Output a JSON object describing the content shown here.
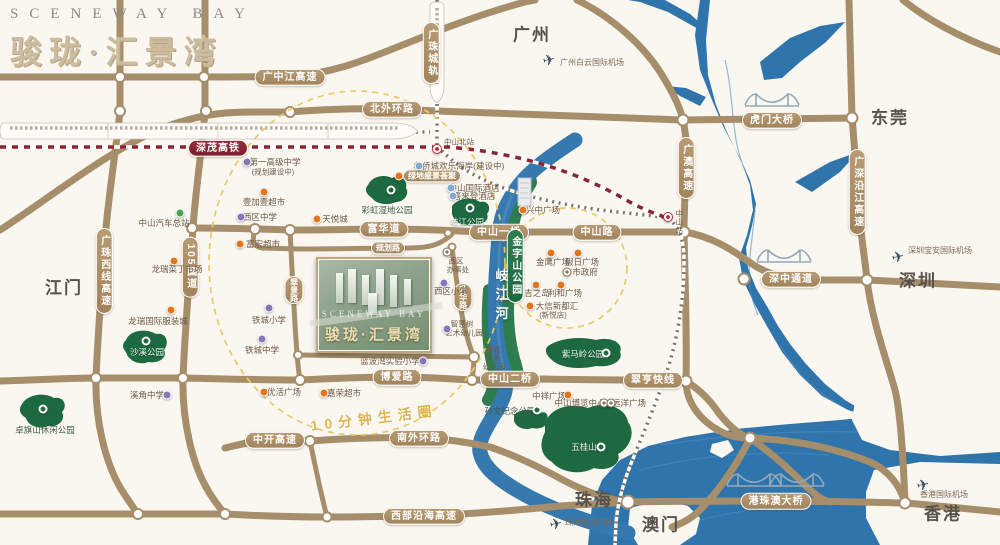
{
  "logo": {
    "en": "SCENEWAY BAY",
    "cn": "骏珑·汇景湾"
  },
  "project": {
    "watermark": "SCENEWAY BAY",
    "title": "骏珑·汇景湾"
  },
  "life_circle_label": {
    "t": "10分钟生活圈",
    "x": 374,
    "y": 418
  },
  "river_label": {
    "t": "岐江河",
    "x": 501,
    "y": 297
  },
  "colors": {
    "road": "#a68e6b",
    "water": "#3074ac",
    "park": "#1d6a40",
    "badge": "#a98b61",
    "rail_badge": "#8c2433",
    "dash_circle": "#e9c967",
    "accent_gold": "#cdbc9e",
    "orange_poi": "#e2761d",
    "school_poi": "#8678b8"
  },
  "badges": [
    {
      "t": "广中江高速",
      "x": 290,
      "y": 77,
      "o": "h",
      "n": "badge-guangzhongjiang-expwy"
    },
    {
      "t": "北外环路",
      "x": 392,
      "y": 109,
      "o": "h",
      "n": "badge-north-outer-ring"
    },
    {
      "t": "深茂高铁",
      "x": 218,
      "y": 148,
      "o": "h",
      "c": "rail",
      "n": "badge-shenmao-hsr"
    },
    {
      "t": "广珠城轨",
      "x": 431,
      "y": 53,
      "o": "v",
      "n": "badge-guangzhu-rail"
    },
    {
      "t": "富华道",
      "x": 384,
      "y": 229,
      "o": "h",
      "n": "badge-fuhua-road"
    },
    {
      "t": "规划路",
      "x": 388,
      "y": 248,
      "o": "h",
      "s": 1,
      "n": "badge-planned-road"
    },
    {
      "t": "中山一桥",
      "x": 499,
      "y": 232,
      "o": "h",
      "n": "badge-zhongshan-bridge-1"
    },
    {
      "t": "中山路",
      "x": 597,
      "y": 232,
      "o": "h",
      "n": "badge-zhongshan-road"
    },
    {
      "t": "广澳高速",
      "x": 686,
      "y": 168,
      "o": "v",
      "n": "badge-guangao-expwy"
    },
    {
      "t": "广深沿江高速",
      "x": 857,
      "y": 192,
      "o": "v",
      "n": "badge-guangshen-riverside-expwy"
    },
    {
      "t": "广珠西线高速",
      "x": 104,
      "y": 271,
      "o": "v",
      "n": "badge-guangzhu-west-expwy"
    },
    {
      "t": "105国道",
      "x": 190,
      "y": 267,
      "o": "v",
      "n": "badge-g105"
    },
    {
      "t": "翠景路",
      "x": 294,
      "y": 290,
      "o": "v",
      "s": 1,
      "n": "badge-cuijing-road"
    },
    {
      "t": "升华路",
      "x": 463,
      "y": 297,
      "o": "v",
      "s": 1,
      "n": "badge-shenghua-road"
    },
    {
      "t": "金字山公园",
      "x": 515,
      "y": 266,
      "o": "v",
      "c": "green",
      "n": "badge-jinzishan-park"
    },
    {
      "t": "博爱路",
      "x": 397,
      "y": 377,
      "o": "h",
      "n": "badge-boai-road"
    },
    {
      "t": "中山二桥",
      "x": 510,
      "y": 379,
      "o": "h",
      "n": "badge-zhongshan-bridge-2"
    },
    {
      "t": "翠亨快线",
      "x": 653,
      "y": 380,
      "o": "h",
      "n": "badge-cuiheng-express"
    },
    {
      "t": "南外环路",
      "x": 419,
      "y": 438,
      "o": "h",
      "n": "badge-south-outer-ring"
    },
    {
      "t": "中开高速",
      "x": 275,
      "y": 440,
      "o": "h",
      "n": "badge-zhongkai-expwy"
    },
    {
      "t": "西部沿海高速",
      "x": 424,
      "y": 516,
      "o": "h",
      "n": "badge-west-coastal-expwy"
    },
    {
      "t": "深中通道",
      "x": 791,
      "y": 279,
      "o": "h",
      "n": "badge-shenzhong-corridor"
    },
    {
      "t": "虎门大桥",
      "x": 772,
      "y": 120,
      "o": "h",
      "n": "badge-humen-bridge"
    },
    {
      "t": "港珠澳大桥",
      "x": 776,
      "y": 501,
      "o": "h",
      "n": "badge-hzm-bridge"
    },
    {
      "t": "绿地盛景荟聚",
      "x": 432,
      "y": 176,
      "o": "h",
      "s": 1,
      "n": "badge-shengjing-huiju"
    }
  ],
  "labels": [
    {
      "t": "广州",
      "x": 532,
      "y": 35,
      "c": "city",
      "n": "city-guangzhou"
    },
    {
      "t": "东莞",
      "x": 890,
      "y": 118,
      "c": "city",
      "n": "city-dongguan"
    },
    {
      "t": "深圳",
      "x": 918,
      "y": 281,
      "c": "city",
      "n": "city-shenzhen"
    },
    {
      "t": "江门",
      "x": 64,
      "y": 288,
      "c": "city",
      "n": "city-jiangmen"
    },
    {
      "t": "珠海",
      "x": 594,
      "y": 500,
      "c": "city",
      "n": "city-zhuhai"
    },
    {
      "t": "澳门",
      "x": 661,
      "y": 525,
      "c": "city",
      "n": "city-macau"
    },
    {
      "t": "香港",
      "x": 943,
      "y": 514,
      "c": "city",
      "n": "city-hongkong"
    },
    {
      "t": "广州白云国际机场",
      "x": 592,
      "y": 63,
      "c": "air",
      "n": "label-baiyun-airport"
    },
    {
      "t": "深圳宝安国际机场",
      "x": 940,
      "y": 251,
      "c": "air",
      "n": "label-baoan-airport"
    },
    {
      "t": "珠海金湾机场",
      "x": 589,
      "y": 523,
      "c": "air",
      "n": "label-jinwan-airport"
    },
    {
      "t": "香港国际机场",
      "x": 944,
      "y": 495,
      "c": "air",
      "n": "label-hk-airport"
    },
    {
      "t": "中山北站",
      "x": 459,
      "y": 142,
      "c": "tiny",
      "n": "label-zhongshan-north-station"
    },
    {
      "t": "中山站",
      "x": 679,
      "y": 222,
      "c": "tv",
      "n": "label-zhongshan-station"
    },
    {
      "t": "彩虹湿地公园",
      "x": 387,
      "y": 210,
      "c": "park",
      "n": "label-rainbow-wetland-park"
    },
    {
      "t": "岐江公园",
      "x": 467,
      "y": 222,
      "c": "parkw",
      "n": "label-qijiang-park"
    },
    {
      "t": "沙溪公园",
      "x": 147,
      "y": 352,
      "c": "parkw",
      "n": "label-shaxi-park"
    },
    {
      "t": "卓旗山休闲公园",
      "x": 45,
      "y": 430,
      "c": "park",
      "n": "label-zhuoqishan-park"
    },
    {
      "t": "紫马岭公园",
      "x": 583,
      "y": 354,
      "c": "parkw",
      "n": "label-zimaling-park"
    },
    {
      "t": "五桂山",
      "x": 584,
      "y": 447,
      "c": "parkw",
      "n": "label-wuguishan"
    },
    {
      "t": "孙文纪念公园",
      "x": 510,
      "y": 411,
      "c": "park",
      "n": "label-sunwen-memorial-park"
    },
    {
      "t": "天悦城",
      "x": 335,
      "y": 219,
      "c": "poi",
      "n": "label-tianyue-city"
    },
    {
      "t": "兴中广场",
      "x": 543,
      "y": 210,
      "c": "poi",
      "n": "label-xingzhong-plaza"
    },
    {
      "t": "金鹰广场",
      "x": 553,
      "y": 262,
      "c": "poi",
      "n": "label-jinying-plaza"
    },
    {
      "t": "假日广场",
      "x": 582,
      "y": 262,
      "c": "poi",
      "n": "label-holiday-plaza"
    },
    {
      "t": "市政府",
      "x": 585,
      "y": 272,
      "c": "poi",
      "n": "label-city-government"
    },
    {
      "t": "吉之岛",
      "x": 537,
      "y": 293,
      "c": "poi",
      "n": "label-jusco"
    },
    {
      "t": "利和广场",
      "x": 565,
      "y": 293,
      "c": "poi",
      "n": "label-lihe-plaza"
    },
    {
      "t": "大信新都汇",
      "x": 557,
      "y": 306,
      "c": "poi",
      "n": "label-daxin-metro-mall"
    },
    {
      "t": "(新悦店)",
      "x": 553,
      "y": 315,
      "c": "tiny",
      "n": "label-daxin-xinyue"
    },
    {
      "t": "中祥广场",
      "x": 549,
      "y": 396,
      "c": "poi",
      "n": "label-zhongxiang-plaza"
    },
    {
      "t": "中山博览中心",
      "x": 580,
      "y": 403,
      "c": "poi",
      "n": "label-zhongshan-expo-center"
    },
    {
      "t": "远洋广场",
      "x": 629,
      "y": 403,
      "c": "poi",
      "n": "label-yuanyang-plaza"
    },
    {
      "t": "优活广场",
      "x": 284,
      "y": 392,
      "c": "poi",
      "n": "label-youhuo-plaza"
    },
    {
      "t": "嘉荣超市",
      "x": 344,
      "y": 393,
      "c": "poi",
      "n": "label-jiarong-supermarket"
    },
    {
      "t": "壹加壹超市",
      "x": 264,
      "y": 202,
      "c": "poi",
      "n": "label-yijiayi-supermarket"
    },
    {
      "t": "富宏超市",
      "x": 263,
      "y": 244,
      "c": "poi",
      "n": "label-fuhong-supermarket"
    },
    {
      "t": "龙瑞菜丁市场",
      "x": 177,
      "y": 269,
      "c": "poi",
      "n": "label-longrui-market"
    },
    {
      "t": "龙瑞国际服装城",
      "x": 158,
      "y": 321,
      "c": "poi",
      "n": "label-longrui-garment-city"
    },
    {
      "t": "中山汽车总站",
      "x": 164,
      "y": 223,
      "c": "poi",
      "n": "label-zhongshan-bus-terminal"
    },
    {
      "t": "西区中学",
      "x": 260,
      "y": 217,
      "c": "poi",
      "n": "label-xiqu-middle-school"
    },
    {
      "t": "铁城小学",
      "x": 269,
      "y": 320,
      "c": "poi",
      "n": "label-tiecheng-primary"
    },
    {
      "t": "铁城中学",
      "x": 262,
      "y": 350,
      "c": "poi",
      "n": "label-tiecheng-middle"
    },
    {
      "t": "溪角中学",
      "x": 147,
      "y": 395,
      "c": "poi",
      "n": "label-xijiao-middle"
    },
    {
      "t": "西区小学",
      "x": 451,
      "y": 291,
      "c": "poi",
      "n": "label-xiqu-primary"
    },
    {
      "t": "蓝波湾实验小学",
      "x": 390,
      "y": 361,
      "c": "poi",
      "n": "label-lanbowan-primary"
    },
    {
      "t": "智慧树",
      "x": 462,
      "y": 324,
      "c": "tiny",
      "n": "label-zhihuishu-kindergarten-1"
    },
    {
      "t": "艺术幼儿园",
      "x": 464,
      "y": 333,
      "c": "tiny",
      "n": "label-zhihuishu-kindergarten-2"
    },
    {
      "t": "菊城",
      "x": 493,
      "y": 350,
      "c": "tiny",
      "n": "label-jucheng-kindergarten-1"
    },
    {
      "t": "子弟",
      "x": 493,
      "y": 358,
      "c": "tiny",
      "n": "label-jucheng-kindergarten-2"
    },
    {
      "t": "幼儿园",
      "x": 494,
      "y": 367,
      "c": "tiny",
      "n": "label-jucheng-kindergarten-3"
    },
    {
      "t": "第一高级中学",
      "x": 275,
      "y": 162,
      "c": "poi",
      "n": "label-no1-senior-high"
    },
    {
      "t": "(规划建设中)",
      "x": 273,
      "y": 172,
      "c": "tiny",
      "n": "label-no1-senior-high-note"
    },
    {
      "t": "中山国际酒店",
      "x": 474,
      "y": 188,
      "c": "poi",
      "n": "label-zhongshan-intl-hotel"
    },
    {
      "t": "喜来登酒店",
      "x": 474,
      "y": 196,
      "c": "poi",
      "n": "label-sheraton-hotel"
    },
    {
      "t": "华侨城欢乐海岸(建设中)",
      "x": 459,
      "y": 166,
      "c": "poi",
      "n": "label-oct-happy-coast"
    },
    {
      "t": "西区",
      "x": 456,
      "y": 261,
      "c": "tiny",
      "n": "label-xiqu-office-1"
    },
    {
      "t": "办事处",
      "x": 458,
      "y": 270,
      "c": "tiny",
      "n": "label-xiqu-office-2"
    }
  ],
  "markers": [
    {
      "k": "orange",
      "x": 317,
      "y": 219
    },
    {
      "k": "orange",
      "x": 523,
      "y": 210
    },
    {
      "k": "orange",
      "x": 551,
      "y": 253
    },
    {
      "k": "orange",
      "x": 578,
      "y": 253
    },
    {
      "k": "orange",
      "x": 536,
      "y": 285
    },
    {
      "k": "orange",
      "x": 561,
      "y": 285
    },
    {
      "k": "orange",
      "x": 530,
      "y": 306
    },
    {
      "k": "orange",
      "x": 568,
      "y": 395
    },
    {
      "k": "orange",
      "x": 264,
      "y": 392
    },
    {
      "k": "orange",
      "x": 324,
      "y": 393
    },
    {
      "k": "orange",
      "x": 264,
      "y": 192
    },
    {
      "k": "orange",
      "x": 240,
      "y": 244
    },
    {
      "k": "orange",
      "x": 174,
      "y": 261
    },
    {
      "k": "orange",
      "x": 171,
      "y": 310
    },
    {
      "k": "orange",
      "x": 399,
      "y": 176
    },
    {
      "k": "purple",
      "x": 241,
      "y": 217
    },
    {
      "k": "purple",
      "x": 269,
      "y": 308
    },
    {
      "k": "purple",
      "x": 262,
      "y": 339
    },
    {
      "k": "purple",
      "x": 167,
      "y": 395
    },
    {
      "k": "purple",
      "x": 444,
      "y": 283
    },
    {
      "k": "purple",
      "x": 423,
      "y": 361
    },
    {
      "k": "purple",
      "x": 447,
      "y": 329
    },
    {
      "k": "purple",
      "x": 247,
      "y": 162
    },
    {
      "k": "green",
      "x": 180,
      "y": 213
    },
    {
      "k": "blue",
      "x": 451,
      "y": 188
    },
    {
      "k": "blue",
      "x": 453,
      "y": 196
    },
    {
      "k": "blue",
      "x": 419,
      "y": 166
    },
    {
      "k": "ring",
      "x": 567,
      "y": 272
    },
    {
      "k": "ring",
      "x": 604,
      "y": 403
    },
    {
      "k": "ring",
      "x": 611,
      "y": 403
    },
    {
      "k": "ring",
      "x": 447,
      "y": 252
    },
    {
      "k": "station",
      "x": 437,
      "y": 149
    },
    {
      "k": "station",
      "x": 668,
      "y": 217
    },
    {
      "k": "parkdot",
      "x": 391,
      "y": 190
    },
    {
      "k": "parkdot",
      "x": 470,
      "y": 208
    },
    {
      "k": "parkdot",
      "x": 146,
      "y": 341
    },
    {
      "k": "parkdot",
      "x": 43,
      "y": 409
    },
    {
      "k": "parkdot",
      "x": 606,
      "y": 353
    },
    {
      "k": "parkdot",
      "x": 601,
      "y": 447
    },
    {
      "k": "parkdot",
      "x": 537,
      "y": 410
    },
    {
      "k": "plane",
      "x": 549,
      "y": 60
    },
    {
      "k": "plane",
      "x": 898,
      "y": 257
    },
    {
      "k": "plane",
      "x": 556,
      "y": 524
    },
    {
      "k": "plane",
      "x": 923,
      "y": 485
    }
  ]
}
